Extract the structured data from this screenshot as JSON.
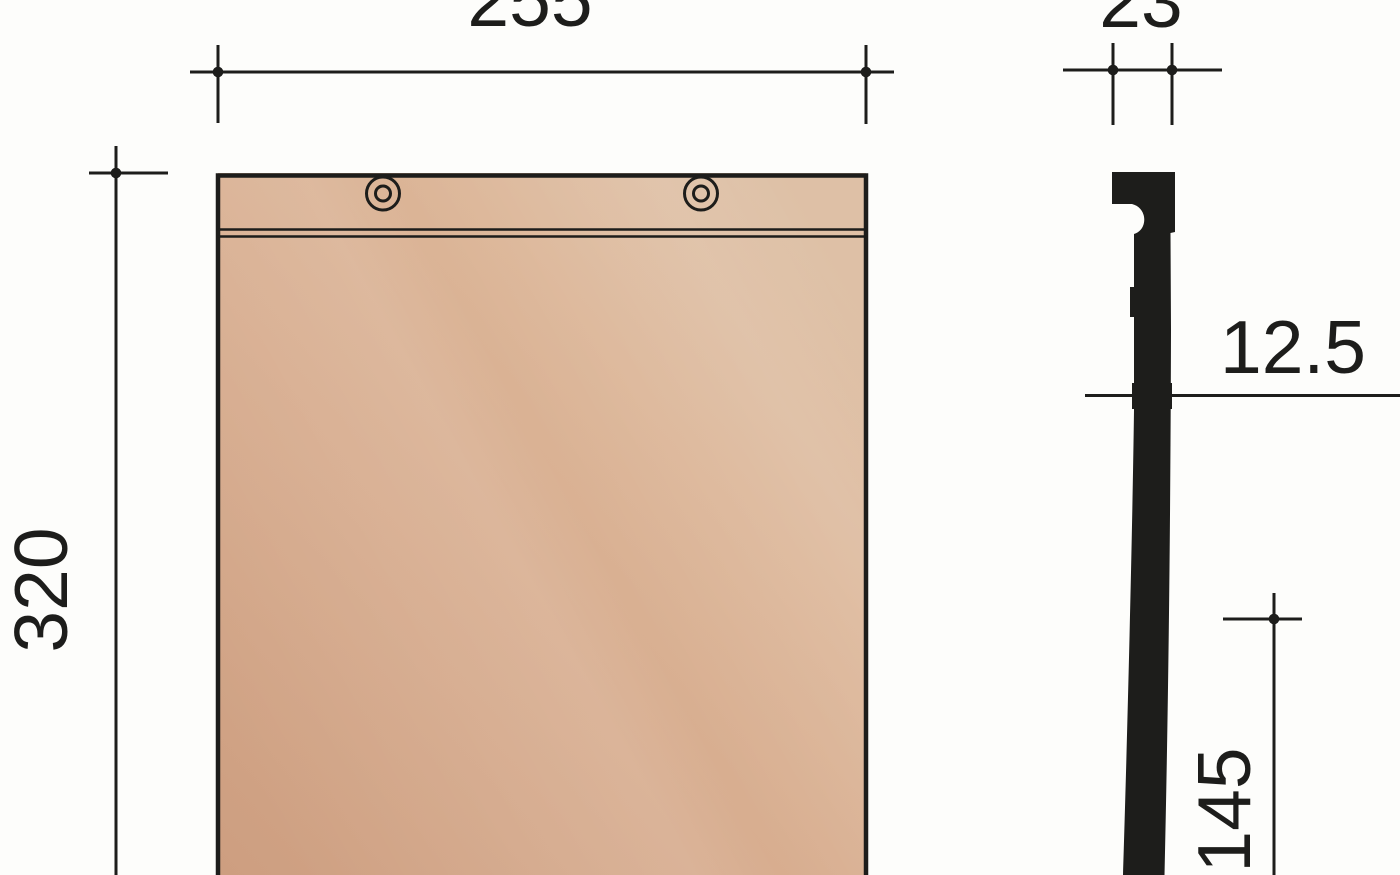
{
  "drawing": {
    "kind": "technical dimension drawing",
    "subject": "flat plain roof tile - front view and side profile section",
    "labels": {
      "width": "255",
      "height": "320",
      "head_width": "23",
      "thickness": "12.5",
      "lower_length": "145"
    },
    "colors": {
      "background": "#fdfdfb",
      "line": "#1d1d1b",
      "tile_gradient": [
        "#cd9e80",
        "#d7ac8e",
        "#dcb698",
        "#ddbfa4"
      ]
    }
  }
}
